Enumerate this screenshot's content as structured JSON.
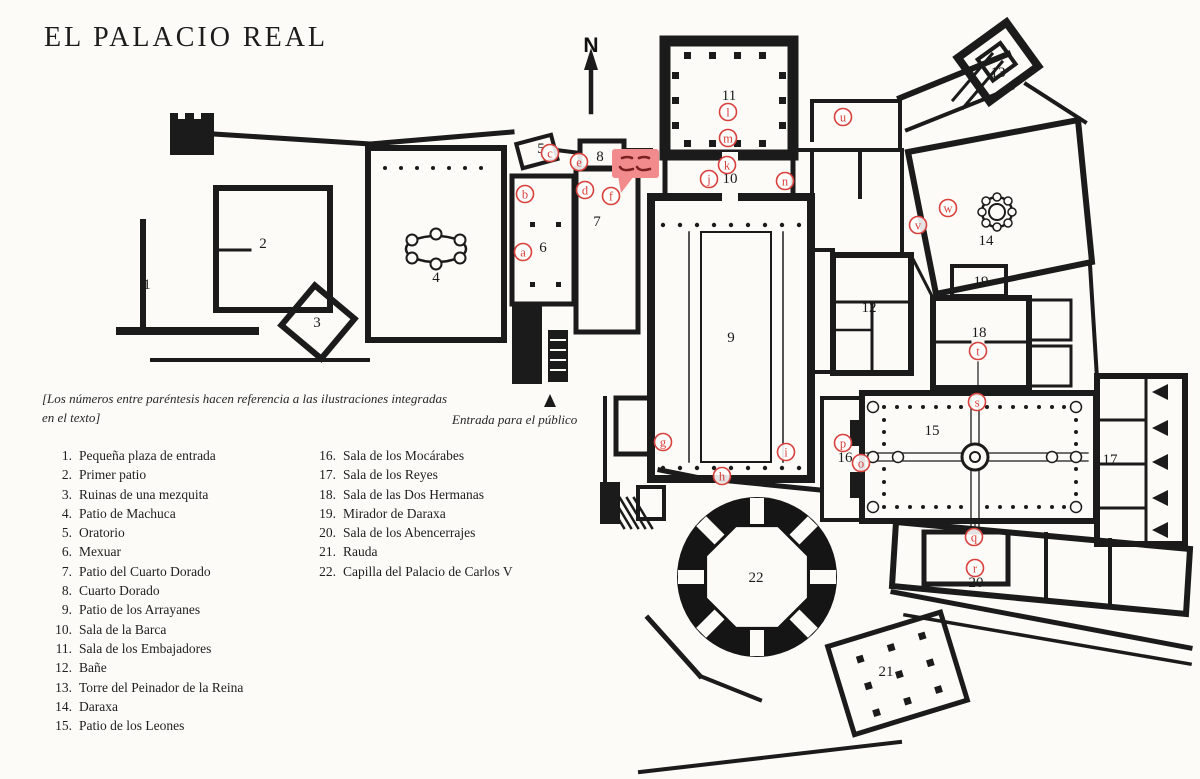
{
  "page": {
    "title": "EL PALACIO REAL"
  },
  "compass": {
    "label": "N"
  },
  "entrance": {
    "label": "Entrada para el público"
  },
  "note": {
    "line1": "[Los números entre paréntesis hacen referencia a las ilustraciones integradas",
    "line2": "en el texto]"
  },
  "annotation": {
    "text": "ここ",
    "bubble_color": "#f28b8c",
    "glyph_color": "#7c2022"
  },
  "legend": {
    "column1": [
      {
        "num": "1.",
        "label": "Pequeña plaza de entrada"
      },
      {
        "num": "2.",
        "label": "Primer patio"
      },
      {
        "num": "3.",
        "label": "Ruinas de una mezquita"
      },
      {
        "num": "4.",
        "label": "Patio de Machuca"
      },
      {
        "num": "5.",
        "label": "Oratorio"
      },
      {
        "num": "6.",
        "label": "Mexuar"
      },
      {
        "num": "7.",
        "label": "Patio del Cuarto Dorado"
      },
      {
        "num": "8.",
        "label": "Cuarto Dorado"
      },
      {
        "num": "9.",
        "label": "Patio de los Arrayanes"
      },
      {
        "num": "10.",
        "label": "Sala de la Barca"
      },
      {
        "num": "11.",
        "label": "Sala de los Embajadores"
      },
      {
        "num": "12.",
        "label": "Bañe"
      },
      {
        "num": "13.",
        "label": "Torre del Peinador de la Reina"
      },
      {
        "num": "14.",
        "label": "Daraxa"
      },
      {
        "num": "15.",
        "label": "Patio de los Leones"
      }
    ],
    "column2": [
      {
        "num": "16.",
        "label": "Sala de los Mocárabes"
      },
      {
        "num": "17.",
        "label": "Sala de los Reyes"
      },
      {
        "num": "18.",
        "label": "Sala de las Dos Hermanas"
      },
      {
        "num": "19.",
        "label": "Mirador de Daraxa"
      },
      {
        "num": "20.",
        "label": "Sala de los Abencerrajes"
      },
      {
        "num": "21.",
        "label": "Rauda"
      },
      {
        "num": "22.",
        "label": "Capilla del Palacio de Carlos V"
      }
    ]
  },
  "plan": {
    "marker_color": "#d8403c",
    "numbers": [
      {
        "n": "1",
        "x": 147,
        "y": 285
      },
      {
        "n": "2",
        "x": 263,
        "y": 244
      },
      {
        "n": "3",
        "x": 317,
        "y": 323
      },
      {
        "n": "4",
        "x": 436,
        "y": 278
      },
      {
        "n": "5",
        "x": 541,
        "y": 149
      },
      {
        "n": "6",
        "x": 543,
        "y": 248
      },
      {
        "n": "7",
        "x": 597,
        "y": 222
      },
      {
        "n": "8",
        "x": 600,
        "y": 157
      },
      {
        "n": "9",
        "x": 731,
        "y": 338
      },
      {
        "n": "10",
        "x": 730,
        "y": 179
      },
      {
        "n": "11",
        "x": 729,
        "y": 96
      },
      {
        "n": "12",
        "x": 869,
        "y": 308
      },
      {
        "n": "13",
        "x": 998,
        "y": 73
      },
      {
        "n": "14",
        "x": 986,
        "y": 241
      },
      {
        "n": "15",
        "x": 932,
        "y": 431
      },
      {
        "n": "16",
        "x": 845,
        "y": 458
      },
      {
        "n": "17",
        "x": 1110,
        "y": 460
      },
      {
        "n": "18",
        "x": 979,
        "y": 333
      },
      {
        "n": "19",
        "x": 981,
        "y": 282
      },
      {
        "n": "20",
        "x": 976,
        "y": 583
      },
      {
        "n": "21",
        "x": 886,
        "y": 672
      },
      {
        "n": "22",
        "x": 756,
        "y": 578
      }
    ],
    "letters": [
      {
        "ch": "a",
        "x": 523,
        "y": 252
      },
      {
        "ch": "b",
        "x": 525,
        "y": 194
      },
      {
        "ch": "c",
        "x": 550,
        "y": 153
      },
      {
        "ch": "d",
        "x": 585,
        "y": 190
      },
      {
        "ch": "e",
        "x": 579,
        "y": 162
      },
      {
        "ch": "f",
        "x": 611,
        "y": 196
      },
      {
        "ch": "g",
        "x": 663,
        "y": 442
      },
      {
        "ch": "h",
        "x": 722,
        "y": 476
      },
      {
        "ch": "i",
        "x": 786,
        "y": 452
      },
      {
        "ch": "j",
        "x": 709,
        "y": 179
      },
      {
        "ch": "k",
        "x": 727,
        "y": 165
      },
      {
        "ch": "l",
        "x": 728,
        "y": 112
      },
      {
        "ch": "m",
        "x": 728,
        "y": 138
      },
      {
        "ch": "n",
        "x": 785,
        "y": 181
      },
      {
        "ch": "o",
        "x": 861,
        "y": 463
      },
      {
        "ch": "p",
        "x": 843,
        "y": 443
      },
      {
        "ch": "q",
        "x": 974,
        "y": 537
      },
      {
        "ch": "r",
        "x": 975,
        "y": 568
      },
      {
        "ch": "s",
        "x": 977,
        "y": 402
      },
      {
        "ch": "t",
        "x": 978,
        "y": 351
      },
      {
        "ch": "u",
        "x": 843,
        "y": 117
      },
      {
        "ch": "v",
        "x": 918,
        "y": 225
      },
      {
        "ch": "w",
        "x": 948,
        "y": 208
      }
    ]
  }
}
